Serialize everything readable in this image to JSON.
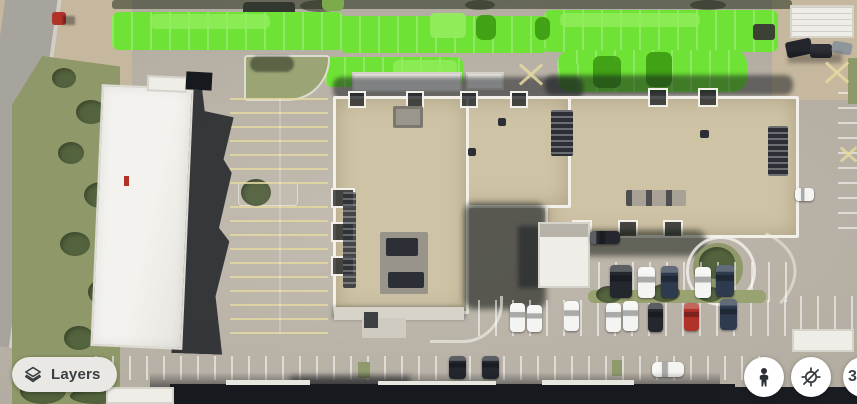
{
  "map": {
    "view": "satellite",
    "description": "Aerial satellite view of an office building complex; north parking rows highlighted in bright green",
    "colors": {
      "pavement": "#b5aea3",
      "pavement_light": "#c3bcb1",
      "road": "#a7a39d",
      "curb": "#dedbd3",
      "grass": "#8e9868",
      "tree": "#4c5c38",
      "dirt": "#c6b89e",
      "roof_tan": "#cfc3a6",
      "parapet": "#f2f0e9",
      "roof_white": "#efede8",
      "roof_dark": "#16191e",
      "shadow": "rgba(17,21,27,0.5)",
      "highlight": "#6fe335",
      "highlight_light": "#92ec5d",
      "highlight_dark": "#3d9c12",
      "car_white": "#f4f4f2",
      "car_dark": "#24282e",
      "car_navy": "#2e3a4d",
      "car_red": "#b03228",
      "line": "rgba(255,255,255,0.55)",
      "line_yellow": "rgba(227,216,160,0.85)",
      "ui_bg": "#e9e8e4",
      "ui_fg": "#3c4043",
      "btn_bg": "#ffffff"
    }
  },
  "controls": {
    "layers_button": {
      "label": "Layers",
      "icon": "layers"
    },
    "street_view_button": {
      "icon": "pegman"
    },
    "location_disabled_button": {
      "icon": "location-disabled"
    },
    "edge_partial_button": {
      "label": "3"
    }
  }
}
